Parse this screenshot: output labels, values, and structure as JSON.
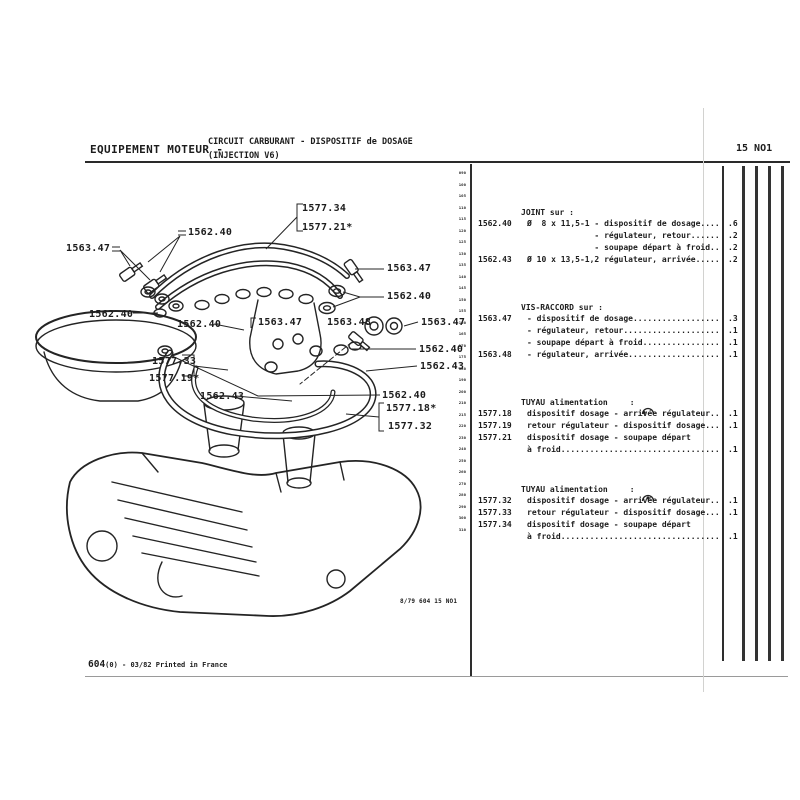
{
  "header": {
    "title_left": "EQUIPEMENT MOTEUR -",
    "title_line1": "CIRCUIT CARBURANT - DISPOSITIF de DOSAGE",
    "title_line2": "(INJECTION V6)",
    "page_code": "15 NO1"
  },
  "diagram": {
    "labels": [
      {
        "text": "1577.34"
      },
      {
        "text": "1577.21*"
      },
      {
        "text": "1562.40"
      },
      {
        "text": "1563.47"
      },
      {
        "text": "1563.47"
      },
      {
        "text": "1562.40"
      },
      {
        "text": "1562.40"
      },
      {
        "text": "1562.40"
      },
      {
        "text": "1563.47"
      },
      {
        "text": "1563.48"
      },
      {
        "text": "1563.47"
      },
      {
        "text": "1562.40"
      },
      {
        "text": "1562.43"
      },
      {
        "text": "1577.33"
      },
      {
        "text": "1577.19*"
      },
      {
        "text": "1562.43"
      },
      {
        "text": "1562.40"
      },
      {
        "text": "1577.18*"
      },
      {
        "text": "1577.32"
      }
    ]
  },
  "margin_markers": [
    "090",
    "100",
    "105",
    "110",
    "115",
    "120",
    "125",
    "130",
    "135",
    "140",
    "145",
    "150",
    "155",
    "160",
    "165",
    "170",
    "175",
    "180",
    "190",
    "200",
    "210",
    "215",
    "220",
    "230",
    "240",
    "250",
    "260",
    "270",
    "280",
    "290",
    "300",
    "310"
  ],
  "parts": {
    "sections": [
      {
        "header": "JOINT sur :",
        "rows": [
          {
            "ref": "1562.40",
            "desc": "Ø  8 x 11,5-1 - dispositif de dosage....",
            "qty": ".6"
          },
          {
            "ref": "",
            "desc": "              - régulateur, retour......",
            "qty": ".2"
          },
          {
            "ref": "",
            "desc": "              - soupape départ à froid..",
            "qty": ".2"
          },
          {
            "ref": "1562.43",
            "desc": "Ø 10 x 13,5-1,2 régulateur, arrivée.....",
            "qty": ".2"
          }
        ]
      },
      {
        "header": "VIS-RACCORD sur :",
        "rows": [
          {
            "ref": "1563.47",
            "desc": "- dispositif de dosage..................",
            "qty": ".3"
          },
          {
            "ref": "",
            "desc": "- régulateur, retour....................",
            "qty": ".1"
          },
          {
            "ref": "",
            "desc": "- soupape départ à froid................",
            "qty": ".1"
          },
          {
            "ref": "1563.48",
            "desc": "- régulateur, arrivée...................",
            "qty": ".1"
          }
        ]
      },
      {
        "header": "TUYAU alimentation",
        "suffix": ":",
        "rows": [
          {
            "ref": "1577.18",
            "desc": "dispositif dosage - arrivée régulateur..",
            "qty": ".1"
          },
          {
            "ref": "1577.19",
            "desc": "retour régulateur - dispositif dosage...",
            "qty": ".1"
          },
          {
            "ref": "1577.21",
            "desc": "dispositif dosage - soupape départ",
            "qty": ""
          },
          {
            "ref": "",
            "desc": "à froid.................................",
            "qty": ".1"
          }
        ]
      },
      {
        "header": "TUYAU alimentation",
        "suffix": ":",
        "rows": [
          {
            "ref": "1577.32",
            "desc": "dispositif dosage - arrivée régulateur..",
            "qty": ".1"
          },
          {
            "ref": "1577.33",
            "desc": "retour régulateur - dispositif dosage...",
            "qty": ".1"
          },
          {
            "ref": "1577.34",
            "desc": "dispositif dosage - soupape départ",
            "qty": ""
          },
          {
            "ref": "",
            "desc": "à froid.................................",
            "qty": ".1"
          }
        ]
      }
    ]
  },
  "footer": {
    "print_ref": "8/79 604  15 NO1",
    "doc_ref_bold": "604",
    "doc_ref_rest": "(0) - 03/82 Printed in France"
  }
}
